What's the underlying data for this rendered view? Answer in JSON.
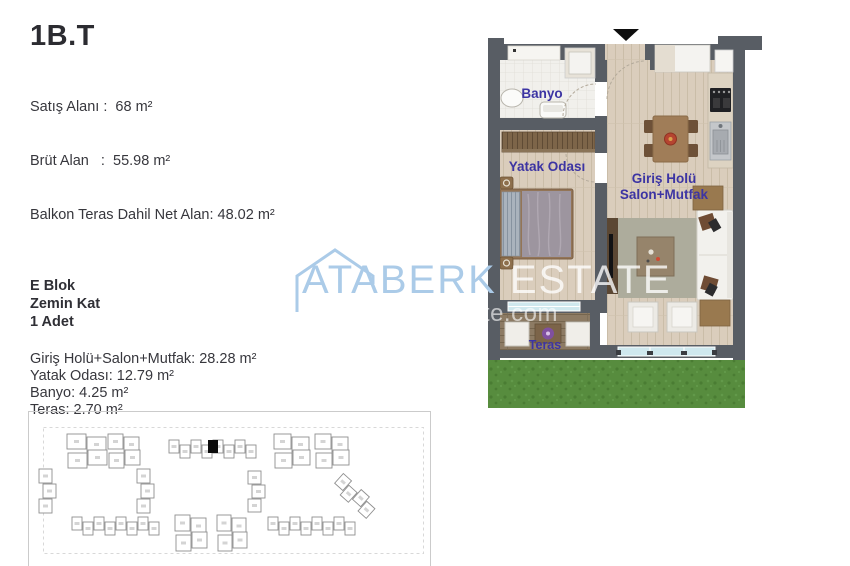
{
  "page": {
    "background": "#ffffff"
  },
  "unit": {
    "title": "1B.T",
    "info_lines": [
      "Satış Alanı :  68 m²",
      "Brüt Alan   :  55.98 m²",
      "Balkon Teras Dahil Net Alan: 48.02 m²"
    ],
    "block_lines": [
      "E Blok",
      "Zemin Kat",
      "1 Adet"
    ],
    "area_lines": [
      "Giriş Holü+Salon+Mutfak: 28.28 m²",
      "Yatak Odası: 12.79 m²",
      "Banyo: 4.25 m²",
      "Teras: 2.70 m²"
    ]
  },
  "floorplan": {
    "labels": {
      "banyo": "Banyo",
      "yatak": "Yatak Odası",
      "salon_line1": "Giriş Holü",
      "salon_line2": "Salon+Mutfak",
      "teras": "Teras"
    },
    "label_color": "#3c34a3",
    "wall_color": "#585d64",
    "grass_color": "#578c3e",
    "window_color": "#cfe8ee"
  },
  "watermark": {
    "brand": "ATABERK",
    "brand_suffix": "ESTATE",
    "url": "ataberkestate.com",
    "brand_color": "#abcbe8"
  },
  "siteplan": {
    "stroke_color": "#8f8f8f",
    "mark_color": "#d4d4d4",
    "highlight_color": "#0b0b0b",
    "clusters": [
      {
        "x": 39,
        "y": 24,
        "cols": 2,
        "rows": 2,
        "bw": 19,
        "bh": 15
      },
      {
        "x": 80,
        "y": 24,
        "cols": 2,
        "rows": 2,
        "bw": 15,
        "bh": 15
      },
      {
        "x": 141,
        "y": 31,
        "cols": 8,
        "rows": 1,
        "bw": 10,
        "bh": 13
      },
      {
        "x": 246,
        "y": 24,
        "cols": 2,
        "rows": 2,
        "bw": 17,
        "bh": 15
      },
      {
        "x": 287,
        "y": 24,
        "cols": 2,
        "rows": 2,
        "bw": 16,
        "bh": 15
      },
      {
        "x": 12,
        "y": 58,
        "cols": 1,
        "rows": 3,
        "bw": 13,
        "bh": 14
      },
      {
        "x": 110,
        "y": 58,
        "cols": 1,
        "rows": 3,
        "bw": 13,
        "bh": 14
      },
      {
        "x": 221,
        "y": 60,
        "cols": 1,
        "rows": 3,
        "bw": 13,
        "bh": 13
      },
      {
        "x": 314,
        "y": 64,
        "cols": 4,
        "rows": 1,
        "bw": 11,
        "bh": 13,
        "angle": 42
      },
      {
        "x": 44,
        "y": 108,
        "cols": 8,
        "rows": 1,
        "bw": 10,
        "bh": 13
      },
      {
        "x": 147,
        "y": 105,
        "cols": 2,
        "rows": 2,
        "bw": 15,
        "bh": 16
      },
      {
        "x": 189,
        "y": 105,
        "cols": 2,
        "rows": 2,
        "bw": 14,
        "bh": 16
      },
      {
        "x": 240,
        "y": 108,
        "cols": 8,
        "rows": 1,
        "bw": 10,
        "bh": 13
      }
    ],
    "highlight": {
      "x": 180,
      "y": 29,
      "w": 10,
      "h": 13
    }
  }
}
